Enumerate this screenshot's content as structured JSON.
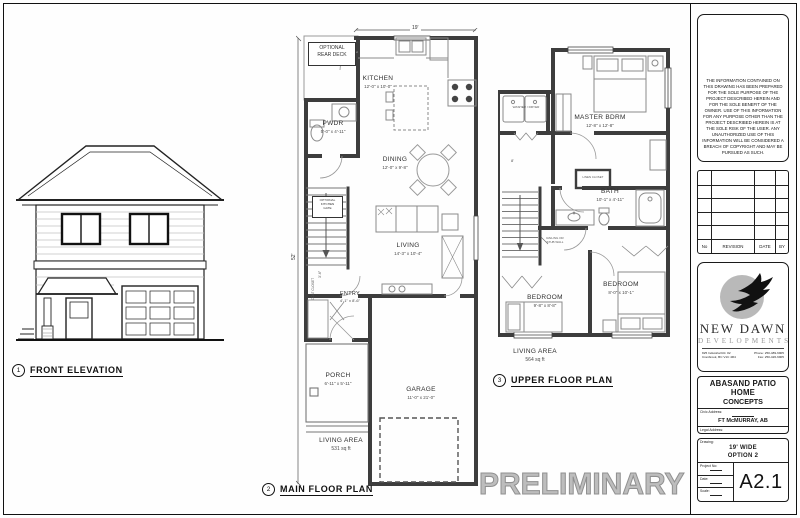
{
  "sheet": {
    "preliminary_watermark": "PRELIMINARY",
    "views": [
      {
        "num": "1",
        "title": "FRONT ELEVATION"
      },
      {
        "num": "2",
        "title": "MAIN FLOOR PLAN"
      },
      {
        "num": "3",
        "title": "UPPER FLOOR PLAN"
      }
    ]
  },
  "main_floor": {
    "width_dim": "19'",
    "depth_dim": "52'",
    "deck_note_line1": "OPTIONAL",
    "deck_note_line2": "REAR DECK",
    "gate_note_line1": "OPTIONAL",
    "gate_note_line2": "KITCHEN",
    "gate_note_line3": "GATE",
    "coat_closet": "COAT CLOSET",
    "stair_dim": "3'-6\"",
    "rooms": {
      "kitchen": {
        "name": "KITCHEN",
        "dims": "12'-0\" x 10'-0\""
      },
      "pwdr": {
        "name": "PWDR",
        "dims": "5'-0\" x 4'-11\""
      },
      "dining": {
        "name": "DINING",
        "dims": "12'-0\" x 9'-8\""
      },
      "living": {
        "name": "LIVING",
        "dims": "14'-3\" x 10'-4\""
      },
      "entry": {
        "name": "ENTRY",
        "dims": "4'-1\" x 8'-6\""
      },
      "porch": {
        "name": "PORCH",
        "dims": "6'-11\" x 5'-11\""
      },
      "garage": {
        "name": "GARAGE",
        "dims": "11'-0\" x 21'-0\""
      }
    },
    "living_area_label": "LIVING AREA",
    "living_area_value": "531 sq ft"
  },
  "upper_floor": {
    "stair_dim": "8'",
    "washer_dryer": "WASHER / DRYER",
    "linen_closet": "LINEN CLOSET",
    "railing_note_line1": "RAILING OR",
    "railing_note_line2": "STUB WALL",
    "rooms": {
      "master": {
        "name": "MASTER BDRM",
        "dims": "12'-8\" x 12'-8\""
      },
      "bath": {
        "name": "BATH",
        "dims": "10'-1\" x 4'-11\""
      },
      "bedroom_left": {
        "name": "BEDROOM",
        "dims": "9'-8\" x 8'-8\""
      },
      "bedroom_right": {
        "name": "BEDROOM",
        "dims": "8'-0\" x 10'-1\""
      }
    },
    "living_area_label": "LIVING AREA",
    "living_area_value": "564 sq ft"
  },
  "title_block": {
    "disclaimer": "THE INFORMATION CONTAINED ON THIS DRAWING HAS BEEN PREPARED FOR THE SOLE PURPOSE OF THE PROJECT DESCRIBED HEREIN AND FOR THE SOLE BENEFIT OF THE OWNER. USE OF THIS INFORMATION FOR ANY PURPOSE OTHER THAN THE PROJECT DESCRIBED HEREIN IS AT THE SOLE RISK OF THE USER. ANY UNAUTHORIZED USE OF THIS INFORMATION WILL BE CONSIDERED A BREACH OF COPYRIGHT AND MAY BE PURSUED AS SUCH.",
    "revision_headers": [
      "No",
      "REVISION",
      "DATE",
      "BY"
    ],
    "logo": {
      "company_line1": "NEW DAWN",
      "company_line2": "DEVELOPMENTS",
      "address_line1": "825 Industrial Rd. #2",
      "address_line2": "Cranbrook, BC  V1C 4R4",
      "phone": "Phone: 250-489-6905",
      "fax": "Fax: 250-426-6905"
    },
    "project": {
      "name_line1": "ABASAND PATIO HOME",
      "name_line2": "CONCEPTS",
      "civic_label": "Civic Address:",
      "civic_value": "FT McMURRAY, AB",
      "legal_label": "Legal Address:"
    },
    "drawing_info": {
      "drawing_label": "Drawing:",
      "drawing_line1": "19' WIDE",
      "drawing_line2": "OPTION 2",
      "project_no_label": "Project No:",
      "date_label": "Date:",
      "scale_label": "Scale:",
      "sheet_number": "A2.1"
    }
  }
}
